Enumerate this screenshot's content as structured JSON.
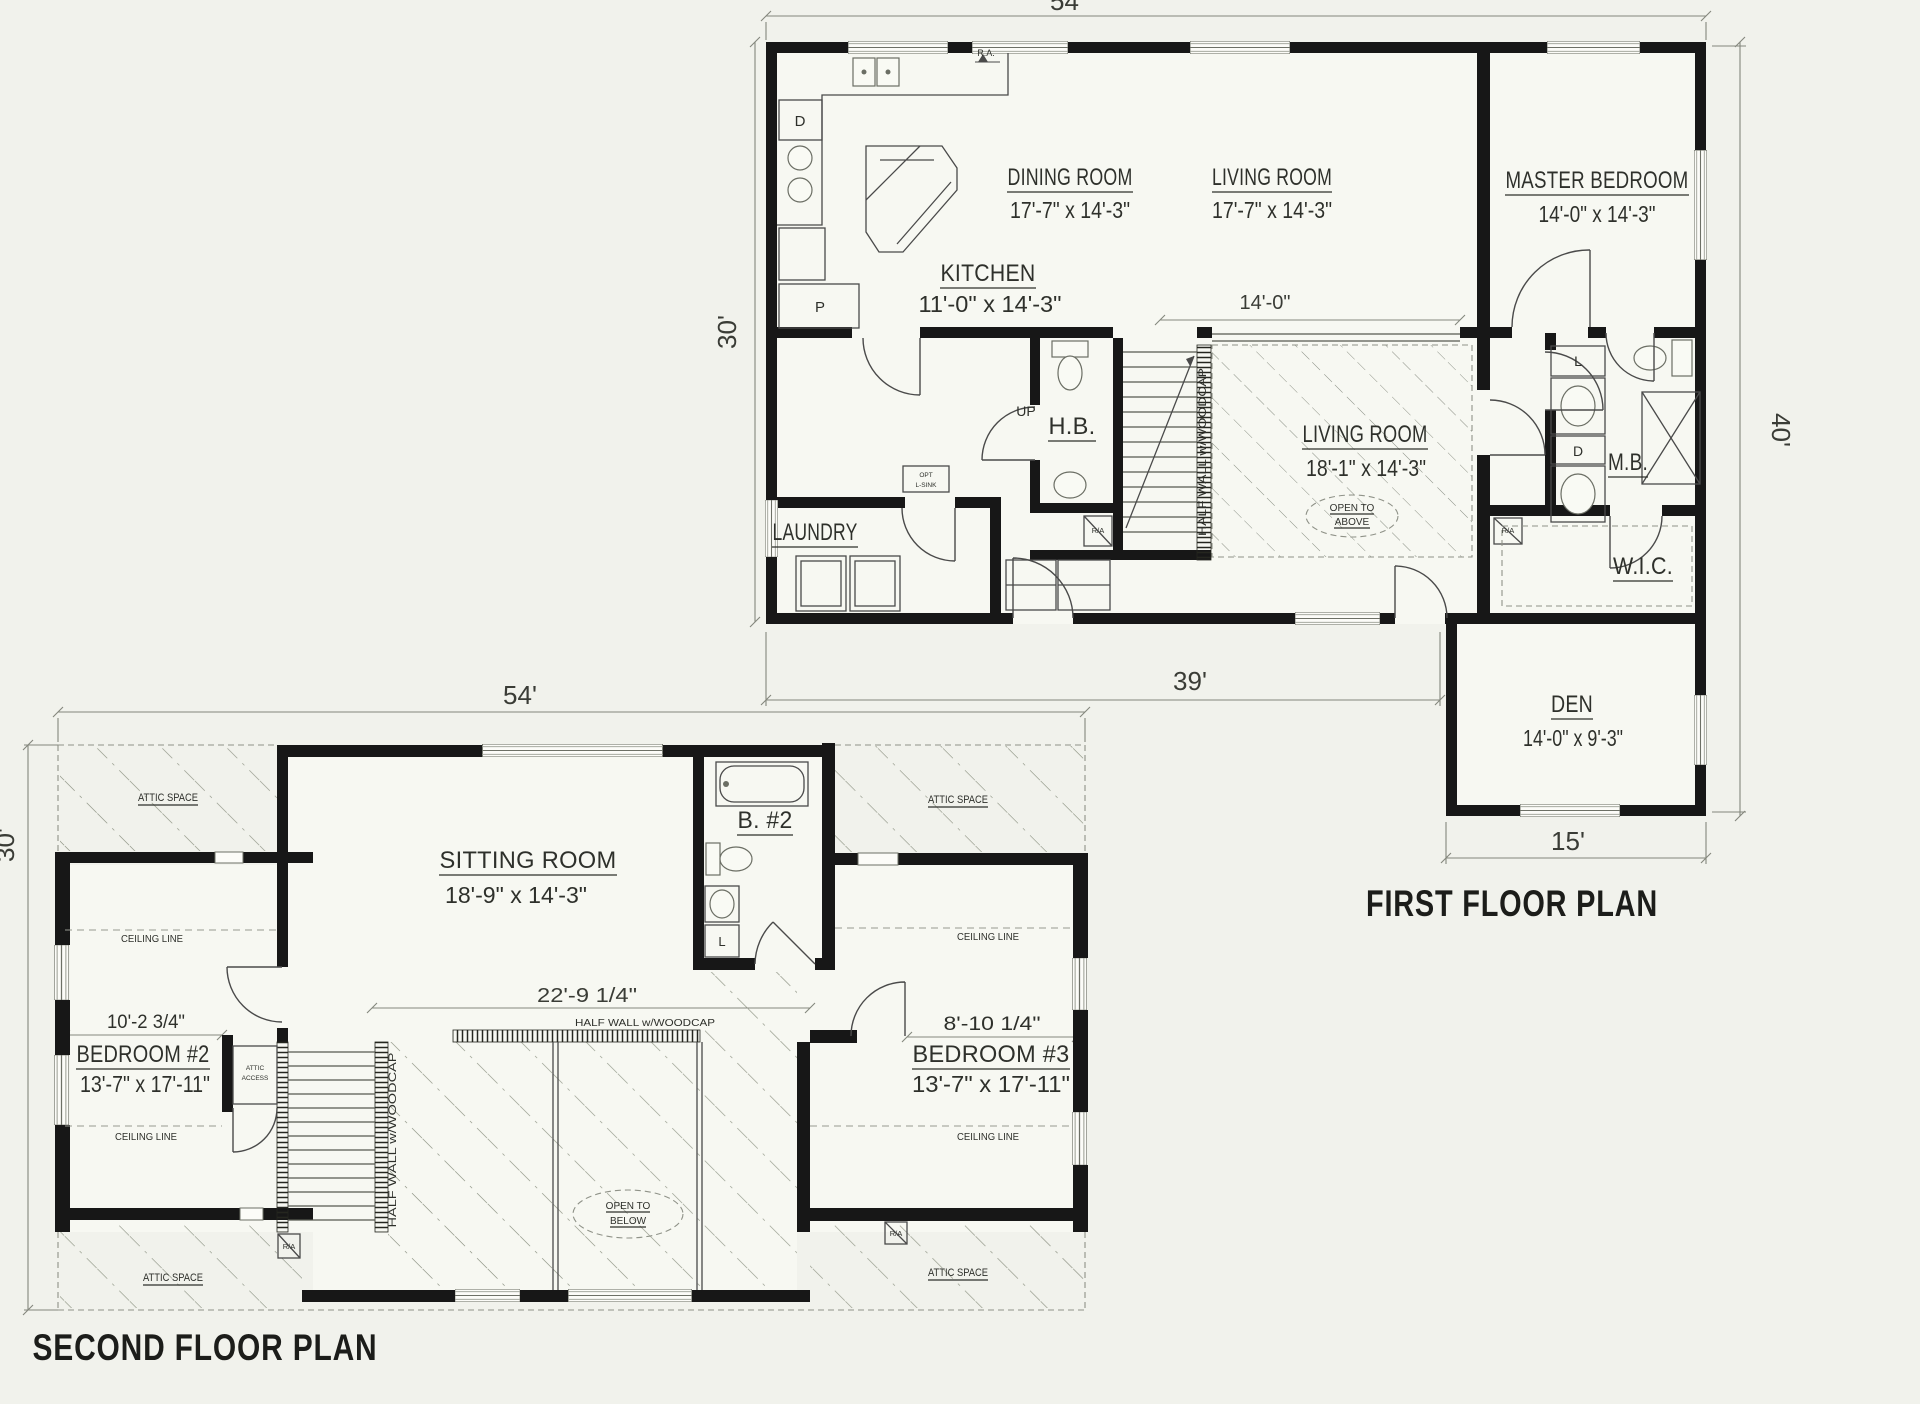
{
  "colors": {
    "paper": "#f1f2ec",
    "ink": "#171717",
    "dimension_lines": "#84877d",
    "hatch": "#8a9080"
  },
  "first_floor": {
    "title": "FIRST FLOOR PLAN",
    "dims": {
      "overall_width": "54'",
      "main_depth": "30'",
      "right_depth": "40'",
      "bottom_width": "39'",
      "den_width": "15'",
      "opening_width": "14'-0\""
    },
    "rooms": {
      "kitchen": {
        "name": "KITCHEN",
        "size": "11'-0\" x 14'-3\""
      },
      "dining": {
        "name": "DINING ROOM",
        "size": "17'-7\" x 14'-3\""
      },
      "living_upper": {
        "name": "LIVING ROOM",
        "size": "17'-7\" x 14'-3\""
      },
      "master": {
        "name": "MASTER BEDROOM",
        "size": "14'-0\" x 14'-3\""
      },
      "living_lower": {
        "name": "LIVING ROOM",
        "size": "18'-1\" x 14'-3\""
      },
      "den": {
        "name": "DEN",
        "size": "14'-0\" x 9'-3\""
      },
      "laundry": {
        "name": "LAUNDRY"
      },
      "half_bath": {
        "name": "H.B."
      },
      "master_bath": {
        "name": "M.B."
      },
      "walk_in_closet": {
        "name": "W.I.C."
      }
    },
    "notes": {
      "open_above_line1": "OPEN TO",
      "open_above_line2": "ABOVE",
      "half_wall": "HALF WALL w/WOODCAP",
      "up": "UP",
      "opt_line1": "OPT",
      "opt_line2": "L-SINK",
      "range_air": "R.A.",
      "return_air": "R/A",
      "dishwasher": "D",
      "pantry": "P",
      "linen": "L",
      "drawers": "D"
    }
  },
  "second_floor": {
    "title": "SECOND FLOOR PLAN",
    "dims": {
      "overall_width": "54'",
      "main_depth": "30'",
      "stair_opening": "22'-9 1/4\"",
      "bedroom2_ceiling": "10'-2 3/4\"",
      "bedroom3_ceiling": "8'-10 1/4\""
    },
    "rooms": {
      "sitting": {
        "name": "SITTING ROOM",
        "size": "18'-9\" x 14'-3\""
      },
      "bath2": {
        "name": "B. #2"
      },
      "bedroom2": {
        "name": "BEDROOM #2",
        "size": "13'-7\" x 17'-11\""
      },
      "bedroom3": {
        "name": "BEDROOM #3",
        "size": "13'-7\" x 17'-11\""
      }
    },
    "notes": {
      "attic": "ATTIC SPACE",
      "ceiling": "CEILING LINE",
      "half_wall": "HALF WALL w/WOODCAP",
      "open_below_line1": "OPEN TO",
      "open_below_line2": "BELOW",
      "attic_access_line1": "ATTIC",
      "attic_access_line2": "ACCESS",
      "return_air": "R/A",
      "linen": "L"
    }
  }
}
